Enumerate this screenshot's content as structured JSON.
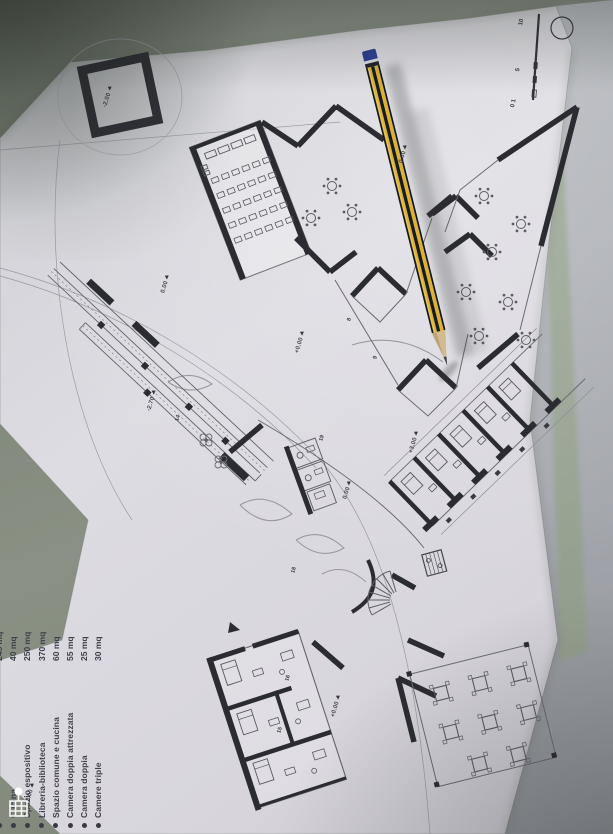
{
  "legend": {
    "items": [
      {
        "label": "",
        "value": "245 mq"
      },
      {
        "label": "Cucina",
        "value": "40 mq"
      },
      {
        "label": "Spazio espositivo",
        "value": "250 mq"
      },
      {
        "label": "Libreria-biblioteca",
        "value": "370 mq"
      },
      {
        "label": "Spazio comune e cucina",
        "value": "60 mq"
      },
      {
        "label": "Camera doppia attrezzata",
        "value": "55 mq"
      },
      {
        "label": "Camera doppia",
        "value": "25 mq"
      },
      {
        "label": "Camere triple",
        "value": "30 mq"
      }
    ]
  },
  "scalebar": {
    "top": "10",
    "middle": "5",
    "bottom": "0 1"
  },
  "plan": {
    "elevations": [
      {
        "text": "-2.00"
      },
      {
        "text": "0.00"
      },
      {
        "text": "-2.70"
      },
      {
        "text": "+0.00"
      },
      {
        "text": "0.00"
      },
      {
        "text": "+3.00"
      },
      {
        "text": "0.00"
      },
      {
        "text": "+0.00"
      },
      {
        "text": "+0.00"
      }
    ],
    "room_numbers": [
      {
        "n": "8"
      },
      {
        "n": "9"
      },
      {
        "n": "14"
      },
      {
        "n": "15"
      },
      {
        "n": "16"
      },
      {
        "n": "18"
      },
      {
        "n": "19"
      }
    ]
  },
  "icons": {
    "bottom_left": "location-pin-icon"
  }
}
